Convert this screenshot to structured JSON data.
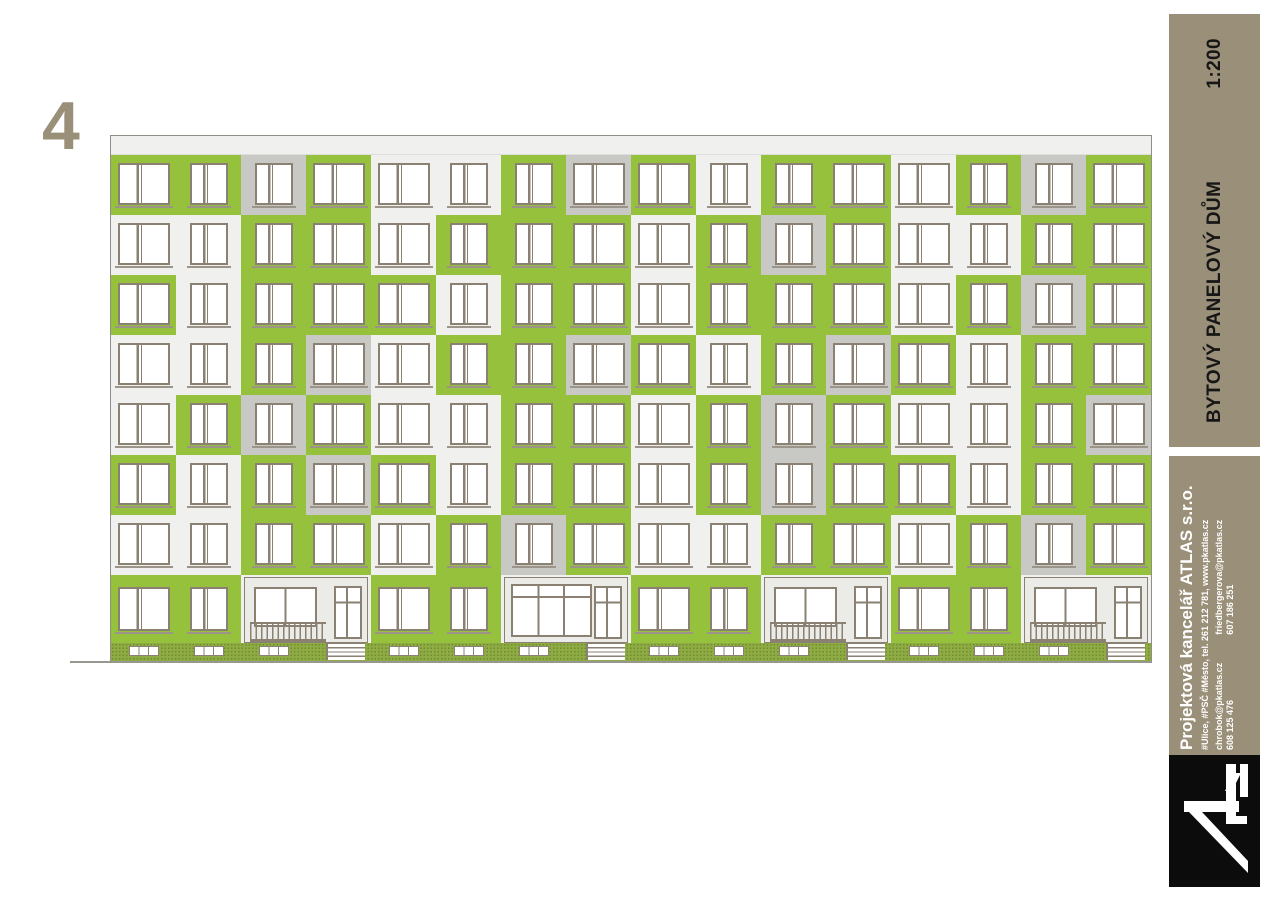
{
  "sheet": {
    "number": "4",
    "scale": "1:200",
    "title": "BYTOVÝ PANELOVÝ DŮM"
  },
  "company": {
    "name": "Projektová kancelář ATLAS s.r.o.",
    "address_line": "#Ulice, #PSČ #Město,  tel.  261 212 781, www.pkatlas.cz",
    "contacts": [
      {
        "email": "chrobok@pkatlas.cz",
        "phone": "608 125 476"
      },
      {
        "email": "friedbergerova@pkatlas.cz",
        "phone": "607 186 251"
      }
    ],
    "logo_name": "ATLAS"
  },
  "colors": {
    "green": "#95c13d",
    "panel_white": "#f0f0ee",
    "panel_gray": "#c8c8c5",
    "frame": "#8a8173",
    "sill": "#9c9488",
    "plinth_green": "#8fac44",
    "plinth_dot": "#6f8c31",
    "band_tan": "#9a8f78",
    "logo_black": "#0c0c0c",
    "outline": "#8f8f88"
  },
  "facade": {
    "floors": 7,
    "columns": 16,
    "panel_legend": {
      "W": "white panel",
      "G": "green panel",
      "S": "gray panel"
    },
    "panel_grid": [
      "GGSGWWGSGWGGWGSG",
      "WWGGWGGGWGSGWWGG",
      "GWGGGWGGWGGGWGSG",
      "WWGSWGGSGWGSGWGG",
      "WGSGWWGGWGSGWWGS",
      "GWGSGWGGWGSGGWGG",
      "WWGGWGSGWWGGWGSG"
    ],
    "window_pattern": "wmmwwmmwwmmwwmmw",
    "ground": {
      "entrance_start_cols": [
        2,
        6,
        10,
        14
      ],
      "entrance_variants": [
        "porch",
        "storefront",
        "porch",
        "porch"
      ]
    }
  }
}
